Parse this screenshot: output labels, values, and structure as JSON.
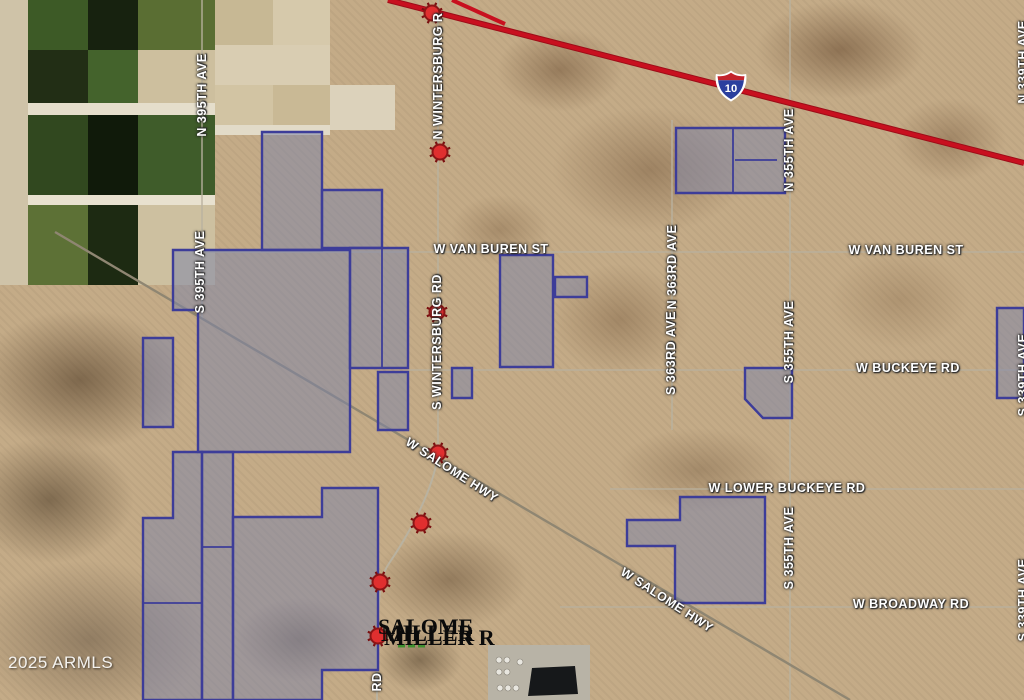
{
  "map": {
    "copyright": "2025 ARMLS",
    "interstate_shield": {
      "route": "10",
      "x": 731,
      "y": 86
    },
    "colors": {
      "desert_base": "#c4ab87",
      "parcel_fill": "rgba(125,132,168,0.52)",
      "parcel_stroke": "#3d3d99",
      "interstate_red": "#c8101f",
      "marker_red": "#e02f2f",
      "marker_ring": "#8c1616",
      "road_gray": "#b9b2a0",
      "label_white": "#ffffff"
    },
    "road_labels": [
      {
        "text": "N WINTERSBURG R",
        "x": 438,
        "y": 76,
        "rot": -90
      },
      {
        "text": "S WINTERSBURG RD",
        "x": 437,
        "y": 342,
        "rot": -90
      },
      {
        "text": "RD",
        "x": 377,
        "y": 682,
        "rot": -90
      },
      {
        "text": "N 395TH AVE",
        "x": 202,
        "y": 95,
        "rot": -90
      },
      {
        "text": "S 395TH AVE",
        "x": 200,
        "y": 272,
        "rot": -90
      },
      {
        "text": "N 355TH AVE",
        "x": 789,
        "y": 150,
        "rot": -90
      },
      {
        "text": "S 355TH AVE",
        "x": 789,
        "y": 342,
        "rot": -90
      },
      {
        "text": "S 355TH AVE",
        "x": 789,
        "y": 548,
        "rot": -90
      },
      {
        "text": "N 363RD AVE",
        "x": 672,
        "y": 267,
        "rot": -90
      },
      {
        "text": "S 363RD AVE",
        "x": 671,
        "y": 353,
        "rot": -90
      },
      {
        "text": "N 339TH AVE",
        "x": 1023,
        "y": 62,
        "rot": -90
      },
      {
        "text": "S 339TH AVE",
        "x": 1023,
        "y": 375,
        "rot": -90
      },
      {
        "text": "S 339TH AVE",
        "x": 1023,
        "y": 600,
        "rot": -90
      },
      {
        "text": "W VAN BUREN ST",
        "x": 491,
        "y": 249,
        "rot": 0
      },
      {
        "text": "W VAN BUREN ST",
        "x": 906,
        "y": 250,
        "rot": 0
      },
      {
        "text": "W BUCKEYE RD",
        "x": 908,
        "y": 368,
        "rot": 0
      },
      {
        "text": "W LOWER BUCKEYE RD",
        "x": 787,
        "y": 488,
        "rot": 0
      },
      {
        "text": "W BROADWAY RD",
        "x": 911,
        "y": 604,
        "rot": 0
      },
      {
        "text": "W SALOME HWY",
        "x": 452,
        "y": 470,
        "rot": 33
      },
      {
        "text": "W SALOME HWY",
        "x": 667,
        "y": 600,
        "rot": 33
      }
    ],
    "stacked_labels": {
      "note": "overlapping illegible black listing labels",
      "items": [
        {
          "text": "SALOME",
          "x": 378,
          "y": 616,
          "size": 22
        },
        {
          "text": "MILLER",
          "x": 381,
          "y": 622,
          "size": 23
        },
        {
          "text": "MILLER R",
          "x": 384,
          "y": 627,
          "size": 22
        }
      ]
    },
    "markers": [
      [
        432,
        13
      ],
      [
        440,
        152
      ],
      [
        437,
        312
      ],
      [
        438,
        453
      ],
      [
        421,
        523
      ],
      [
        380,
        582
      ],
      [
        378,
        636
      ]
    ],
    "parcels": [
      [
        [
          262,
          132
        ],
        [
          322,
          132
        ],
        [
          322,
          250
        ],
        [
          262,
          250
        ]
      ],
      [
        [
          322,
          190
        ],
        [
          382,
          190
        ],
        [
          382,
          248
        ],
        [
          322,
          248
        ]
      ],
      [
        [
          173,
          250
        ],
        [
          350,
          250
        ],
        [
          350,
          452
        ],
        [
          198,
          452
        ],
        [
          198,
          310
        ],
        [
          173,
          310
        ]
      ],
      [
        [
          143,
          338
        ],
        [
          173,
          338
        ],
        [
          173,
          427
        ],
        [
          143,
          427
        ]
      ],
      [
        [
          350,
          248
        ],
        [
          408,
          248
        ],
        [
          408,
          368
        ],
        [
          350,
          368
        ]
      ],
      [
        [
          378,
          372
        ],
        [
          408,
          372
        ],
        [
          408,
          430
        ],
        [
          378,
          430
        ]
      ],
      [
        [
          143,
          518
        ],
        [
          173,
          518
        ],
        [
          173,
          452
        ],
        [
          202,
          452
        ],
        [
          202,
          700
        ],
        [
          143,
          700
        ]
      ],
      [
        [
          202,
          452
        ],
        [
          233,
          452
        ],
        [
          233,
          700
        ],
        [
          202,
          700
        ]
      ],
      [
        [
          233,
          517
        ],
        [
          322,
          517
        ],
        [
          322,
          488
        ],
        [
          378,
          488
        ],
        [
          378,
          670
        ],
        [
          322,
          670
        ],
        [
          322,
          700
        ],
        [
          233,
          700
        ]
      ],
      [
        [
          676,
          128
        ],
        [
          785,
          128
        ],
        [
          785,
          193
        ],
        [
          676,
          193
        ]
      ],
      [
        [
          745,
          368
        ],
        [
          792,
          368
        ],
        [
          792,
          418
        ],
        [
          763,
          418
        ],
        [
          745,
          399
        ]
      ],
      [
        [
          997,
          308
        ],
        [
          1024,
          308
        ],
        [
          1024,
          398
        ],
        [
          997,
          398
        ]
      ],
      [
        [
          627,
          520
        ],
        [
          680,
          520
        ],
        [
          680,
          497
        ],
        [
          765,
          497
        ],
        [
          765,
          603
        ],
        [
          675,
          603
        ],
        [
          675,
          546
        ],
        [
          627,
          546
        ]
      ],
      [
        [
          500,
          255
        ],
        [
          553,
          255
        ],
        [
          553,
          367
        ],
        [
          500,
          367
        ]
      ],
      [
        [
          555,
          277
        ],
        [
          587,
          277
        ],
        [
          587,
          297
        ],
        [
          555,
          297
        ]
      ],
      [
        [
          452,
          368
        ],
        [
          472,
          368
        ],
        [
          472,
          398
        ],
        [
          452,
          398
        ]
      ]
    ],
    "parcel_dividers": [
      [
        382,
        248,
        382,
        368
      ],
      [
        733,
        128,
        733,
        193
      ],
      [
        143,
        603,
        202,
        603
      ],
      [
        202,
        547,
        233,
        547
      ],
      [
        735,
        160,
        777,
        160
      ]
    ],
    "roads": {
      "grid": [
        [
          205,
          252,
          1024,
          252
        ],
        [
          408,
          370,
          1024,
          370
        ],
        [
          610,
          489,
          1024,
          489
        ],
        [
          560,
          607,
          1024,
          607
        ],
        [
          202,
          0,
          202,
          318
        ],
        [
          672,
          120,
          672,
          430
        ],
        [
          790,
          0,
          790,
          700
        ],
        [
          438,
          0,
          438,
          455
        ]
      ],
      "wintersburg_curve": "M438,455 C432,495 405,540 388,565 C378,580 377,610 377,700",
      "salome_diagonal": [
        55,
        232,
        850,
        700
      ],
      "interstate_main": [
        388,
        0,
        1024,
        163
      ],
      "interstate_branch": [
        452,
        0,
        505,
        24
      ]
    },
    "farm_fields": [
      {
        "x": 0,
        "y": 0,
        "w": 215,
        "h": 285,
        "c": "#cfc3a8"
      },
      {
        "x": 28,
        "y": 0,
        "w": 60,
        "h": 50,
        "c": "#3d5a26"
      },
      {
        "x": 88,
        "y": 0,
        "w": 50,
        "h": 50,
        "c": "#17220f"
      },
      {
        "x": 138,
        "y": 0,
        "w": 77,
        "h": 50,
        "c": "#5a6e33"
      },
      {
        "x": 215,
        "y": 0,
        "w": 58,
        "h": 45,
        "c": "#c7b894"
      },
      {
        "x": 273,
        "y": 0,
        "w": 57,
        "h": 45,
        "c": "#d6c9ab"
      },
      {
        "x": 28,
        "y": 50,
        "w": 60,
        "h": 53,
        "c": "#222e15"
      },
      {
        "x": 88,
        "y": 50,
        "w": 50,
        "h": 53,
        "c": "#44632c"
      },
      {
        "x": 138,
        "y": 50,
        "w": 77,
        "h": 53,
        "c": "#cdbf9e"
      },
      {
        "x": 215,
        "y": 45,
        "w": 115,
        "h": 40,
        "c": "#d9cdb2"
      },
      {
        "x": 28,
        "y": 103,
        "w": 187,
        "h": 12,
        "c": "#e5decb"
      },
      {
        "x": 215,
        "y": 85,
        "w": 58,
        "h": 45,
        "c": "#d2c4a3"
      },
      {
        "x": 273,
        "y": 85,
        "w": 57,
        "h": 45,
        "c": "#c9b995"
      },
      {
        "x": 330,
        "y": 85,
        "w": 65,
        "h": 45,
        "c": "#dcd2bb"
      },
      {
        "x": 28,
        "y": 115,
        "w": 60,
        "h": 80,
        "c": "#31481f"
      },
      {
        "x": 88,
        "y": 115,
        "w": 50,
        "h": 80,
        "c": "#101a0a"
      },
      {
        "x": 138,
        "y": 115,
        "w": 77,
        "h": 80,
        "c": "#3f5c2a"
      },
      {
        "x": 215,
        "y": 125,
        "w": 115,
        "h": 10,
        "c": "#e2dbc8"
      },
      {
        "x": 28,
        "y": 195,
        "w": 187,
        "h": 10,
        "c": "#e8e1cf"
      },
      {
        "x": 28,
        "y": 205,
        "w": 60,
        "h": 80,
        "c": "#5d7136"
      },
      {
        "x": 88,
        "y": 205,
        "w": 50,
        "h": 80,
        "c": "#1d2a12"
      },
      {
        "x": 138,
        "y": 205,
        "w": 77,
        "h": 80,
        "c": "#cdc0a0"
      }
    ],
    "industrial_site": {
      "pad": {
        "x": 488,
        "y": 645,
        "w": 102,
        "h": 55,
        "c": "#b8b3a6"
      },
      "pond": [
        [
          532,
          668
        ],
        [
          575,
          666
        ],
        [
          578,
          694
        ],
        [
          528,
          696
        ]
      ],
      "tanks": [
        [
          499,
          660
        ],
        [
          507,
          660
        ],
        [
          499,
          672
        ],
        [
          507,
          672
        ],
        [
          500,
          688
        ],
        [
          508,
          688
        ],
        [
          516,
          688
        ],
        [
          520,
          662
        ]
      ]
    },
    "green_fragment": {
      "x": 398,
      "y": 644,
      "dashes": 3
    }
  }
}
